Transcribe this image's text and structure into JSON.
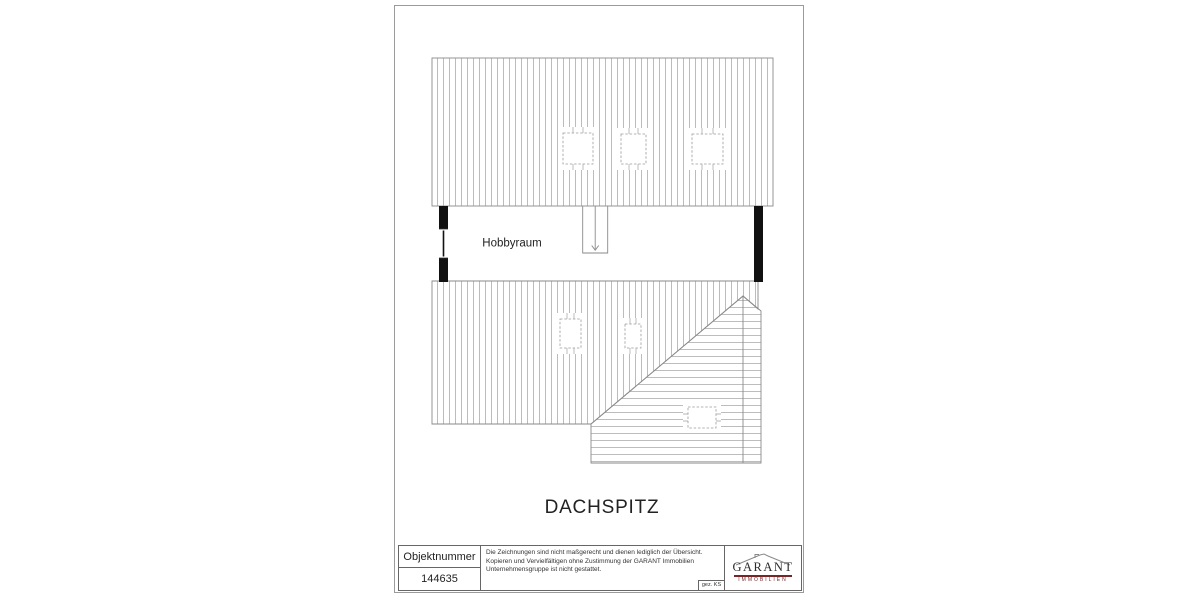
{
  "plan": {
    "room_label": "Hobbyraum",
    "title": "DACHSPITZ",
    "colors": {
      "hatch": "#a0a0a0",
      "outline": "#8a8a8a",
      "wall": "#111111",
      "text": "#1f1f1f"
    }
  },
  "title_block": {
    "object_number_label": "Objektnummer",
    "object_number_value": "144635",
    "disclaimer_lines": [
      "Die Zeichnungen sind nicht maßgerecht und dienen lediglich der Übersicht.",
      "Kopieren und Vervielfältigen ohne Zustimmung der GARANT Immobilien",
      "Unternehmensgruppe ist nicht gestattet."
    ],
    "signature": "gez. KS",
    "logo": {
      "brand": "GARANT",
      "tagline": "IMMOBILIEN",
      "accent_color": "#772526"
    }
  }
}
